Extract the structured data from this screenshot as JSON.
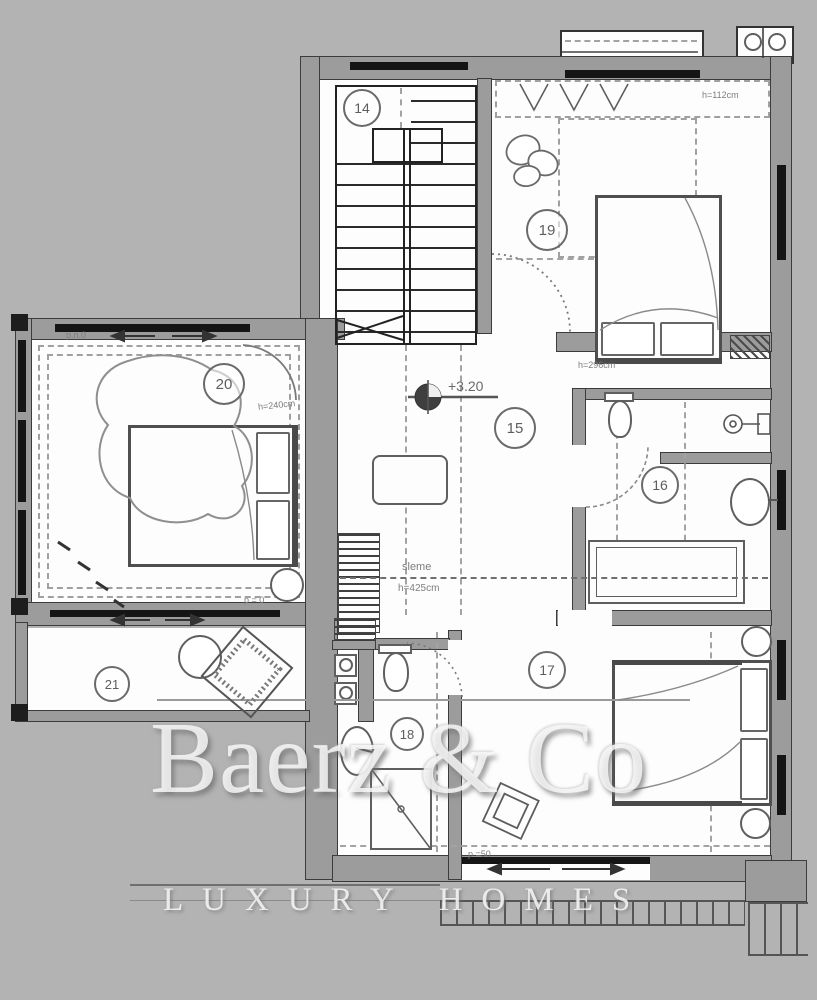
{
  "plan": {
    "rooms": [
      {
        "key": "stairs",
        "number": "14"
      },
      {
        "key": "hall",
        "number": "15"
      },
      {
        "key": "bathroom-main",
        "number": "16"
      },
      {
        "key": "bedroom-southeast",
        "number": "17"
      },
      {
        "key": "bathroom-small",
        "number": "18"
      },
      {
        "key": "bedroom-northeast",
        "number": "19"
      },
      {
        "key": "bedroom-west",
        "number": "20"
      },
      {
        "key": "balcony",
        "number": "21"
      }
    ],
    "annotations": {
      "level_mark": "+3.20",
      "ridge_name": "sleme",
      "ridge_height": "h=425cm",
      "wall_height_112": "h=112cm",
      "wall_height_296": "h=296cm",
      "wall_height_240": "h=240cm",
      "parapet_top": "p.n.0",
      "parapet_bottom": "p = 0",
      "parapet_50": "p =50"
    }
  },
  "watermark": {
    "brand": "Baerz & Co",
    "tagline": "LUXURY HOMES"
  },
  "colors": {
    "background": "#b3b3b3",
    "wall_fill": "#9c9c9c",
    "line": "#2e2e2e",
    "window": "#151515",
    "furniture": "#5f5f5f",
    "watermark": "#fafafa"
  }
}
